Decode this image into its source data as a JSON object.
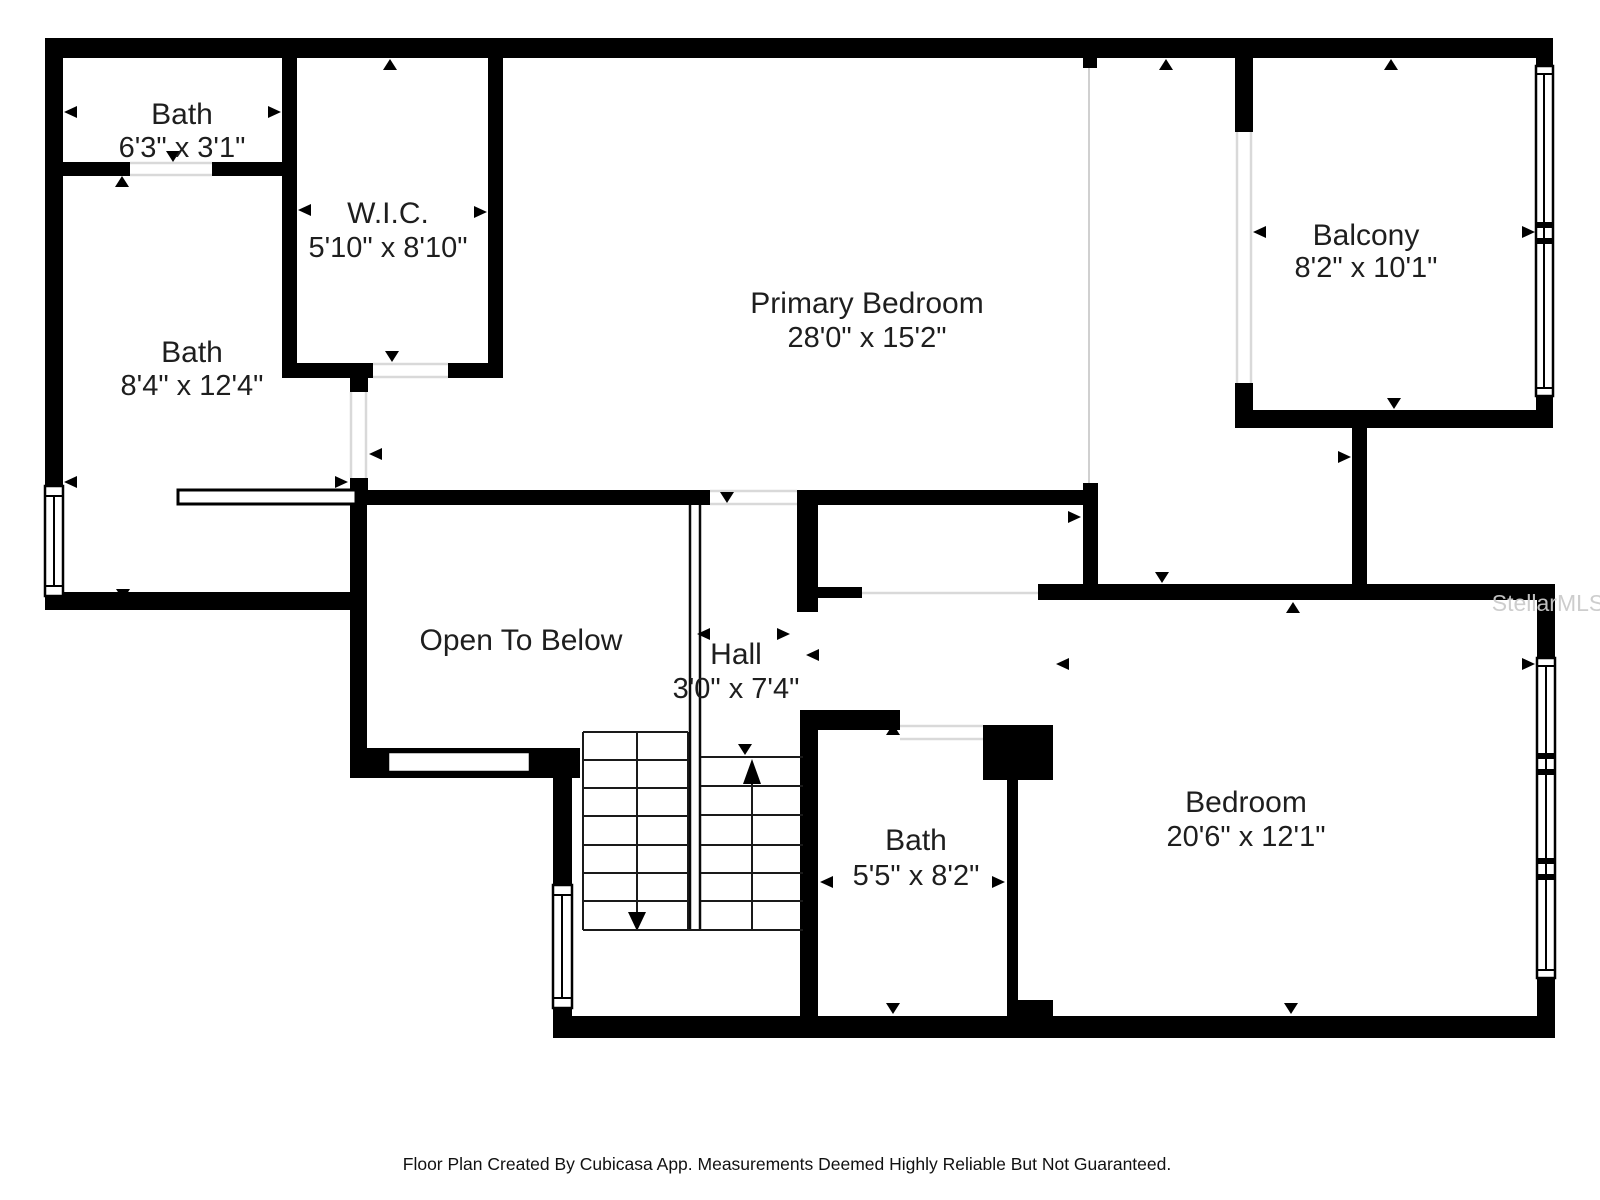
{
  "floor_plan": {
    "rooms": [
      {
        "id": "bath-small",
        "name": "Bath",
        "dimensions": "6'3\" x 3'1\""
      },
      {
        "id": "wic",
        "name": "W.I.C.",
        "dimensions": "5'10\" x 8'10\""
      },
      {
        "id": "bath-main",
        "name": "Bath",
        "dimensions": "8'4\" x 12'4\""
      },
      {
        "id": "primary-bedroom",
        "name": "Primary Bedroom",
        "dimensions": "28'0\" x 15'2\""
      },
      {
        "id": "balcony",
        "name": "Balcony",
        "dimensions": "8'2\" x 10'1\""
      },
      {
        "id": "open-to-below",
        "name": "Open To Below",
        "dimensions": ""
      },
      {
        "id": "hall",
        "name": "Hall",
        "dimensions": "3'0\" x 7'4\""
      },
      {
        "id": "bath-upper",
        "name": "Bath",
        "dimensions": "5'5\" x 8'2\""
      },
      {
        "id": "bedroom",
        "name": "Bedroom",
        "dimensions": "20'6\" x 12'1\""
      }
    ],
    "watermark": "StellarMLS",
    "footer": "Floor Plan Created By Cubicasa App. Measurements Deemed Highly Reliable But Not Guaranteed.",
    "colors": {
      "wall": "#000000",
      "text": "#1e1e1e",
      "threshold": "#d9d9d9",
      "watermark": "#cbcbcb"
    }
  }
}
